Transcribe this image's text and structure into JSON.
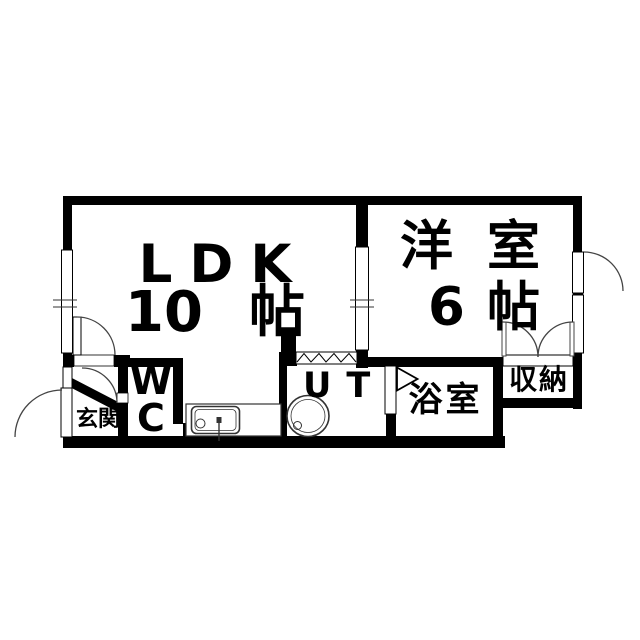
{
  "plan": {
    "type": "apartment-floor-plan",
    "colors": {
      "wall": "#000000",
      "background": "#ffffff",
      "fixture_line": "#333333",
      "arc_line": "#444444"
    },
    "rooms": {
      "ldk": {
        "name": "LDK",
        "size_value": "10",
        "size_unit": "帖"
      },
      "western_room": {
        "name_char1": "洋",
        "name_char2": "室",
        "size_value": "6",
        "size_unit": "帖"
      },
      "wc": {
        "line1": "W",
        "line2": "C"
      },
      "utility": {
        "label": "UT"
      },
      "bathroom": {
        "label": "浴室"
      },
      "storage": {
        "label": "収納"
      },
      "entrance": {
        "label": "玄関"
      }
    }
  }
}
